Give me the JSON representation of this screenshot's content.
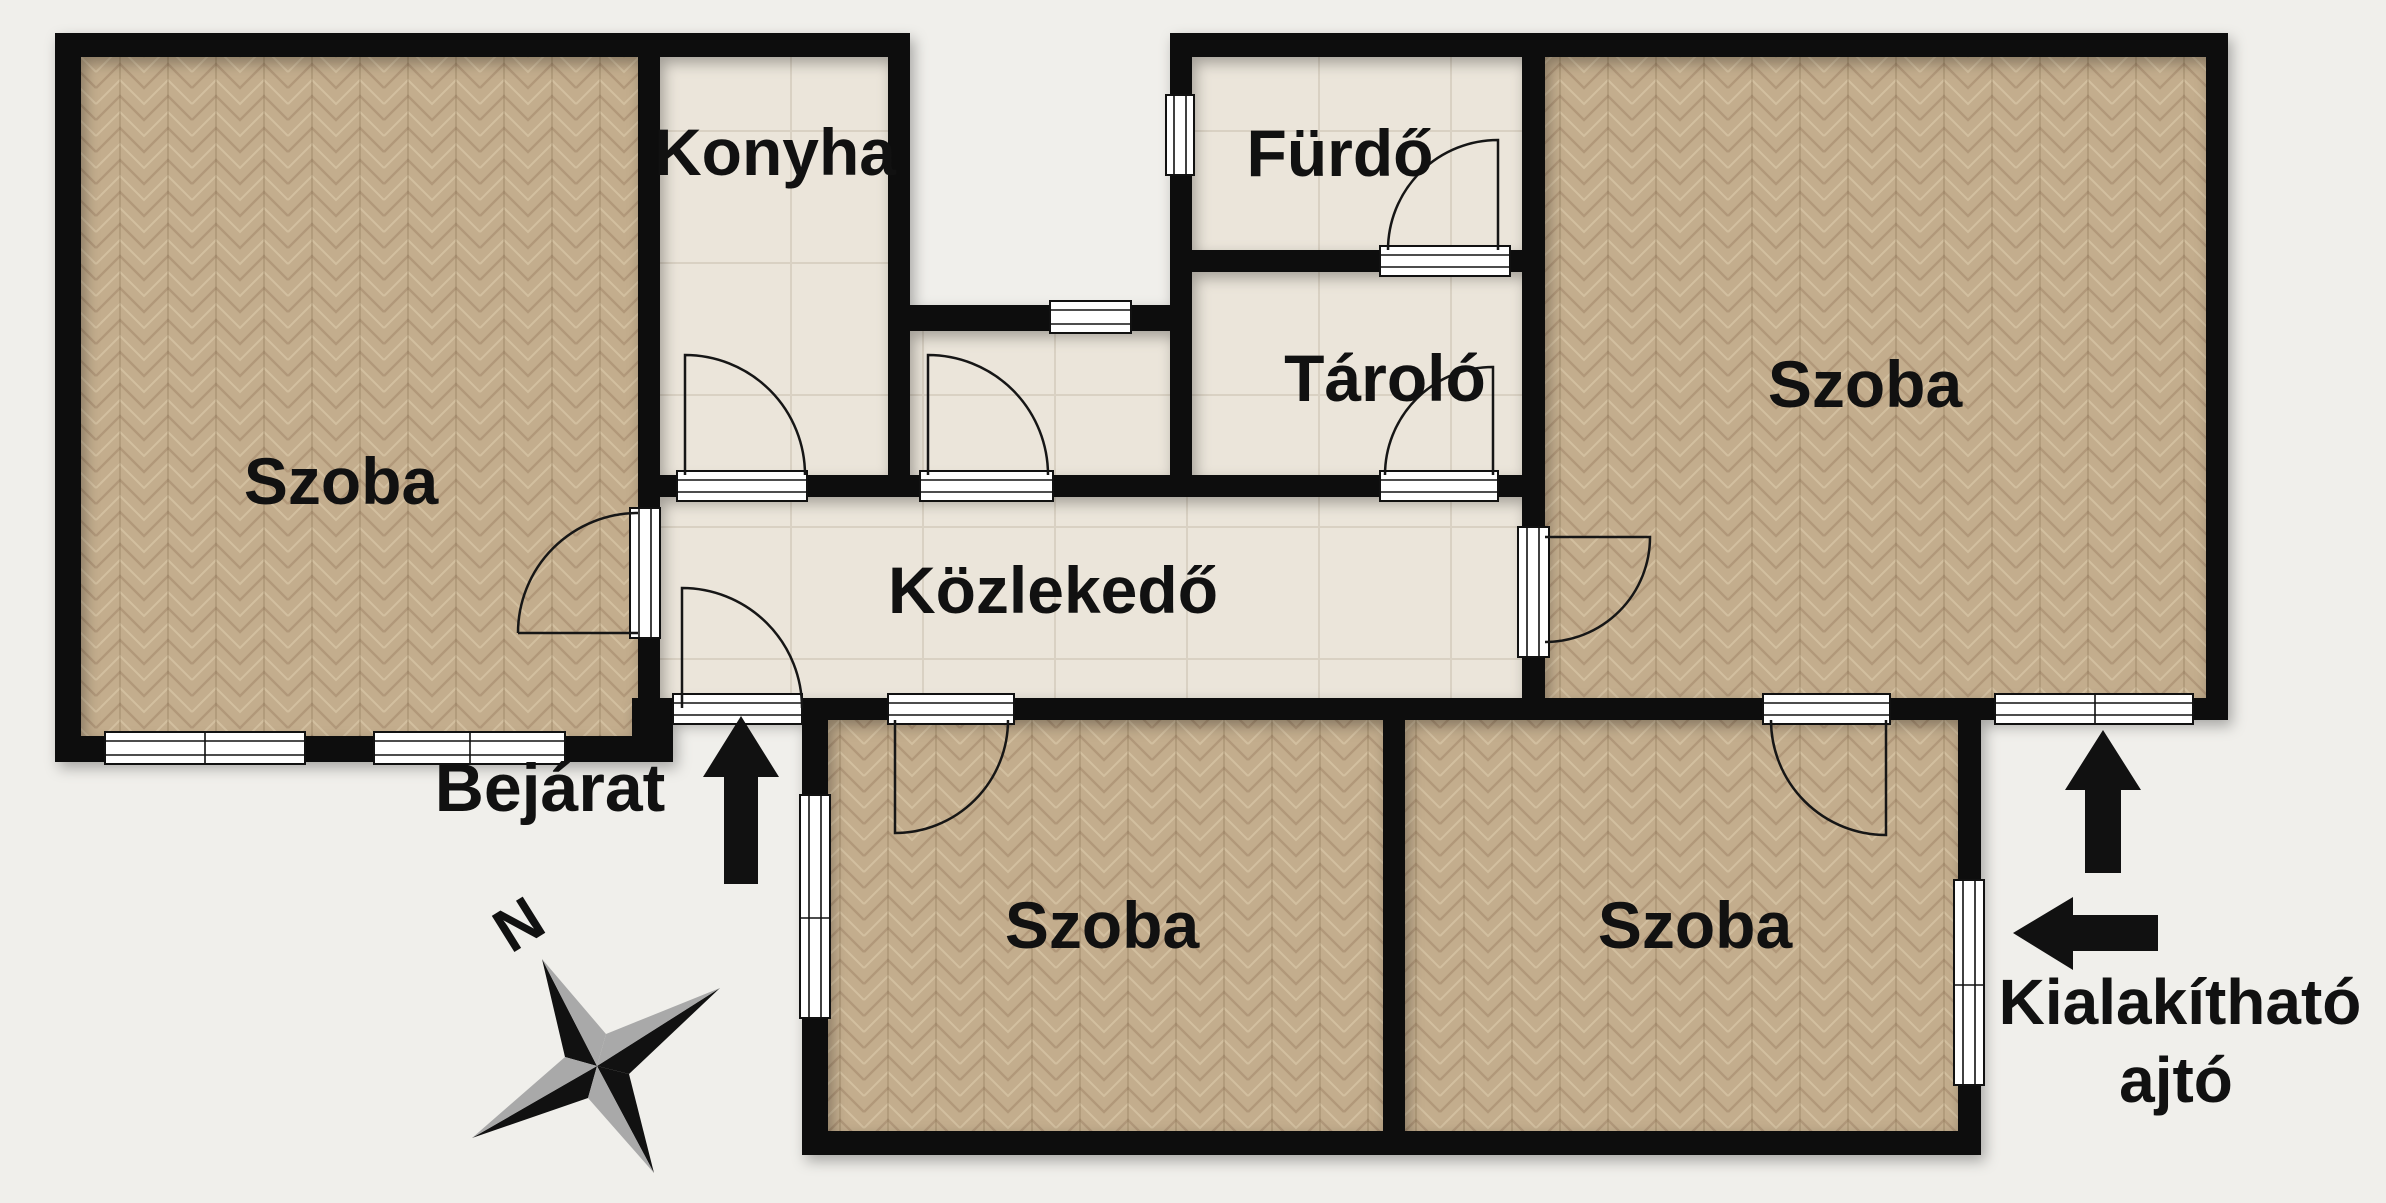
{
  "floorplan": {
    "rooms": [
      {
        "id": "szoba-top-left",
        "label": "Szoba",
        "floor": "parquet"
      },
      {
        "id": "konyha",
        "label": "Konyha",
        "floor": "tile"
      },
      {
        "id": "furdo",
        "label": "Fürdő",
        "floor": "tile"
      },
      {
        "id": "tarolo",
        "label": "Tároló",
        "floor": "tile"
      },
      {
        "id": "kozlekedo",
        "label": "Közlekedő",
        "floor": "tile"
      },
      {
        "id": "szoba-top-right",
        "label": "Szoba",
        "floor": "parquet"
      },
      {
        "id": "szoba-bottom-left",
        "label": "Szoba",
        "floor": "parquet"
      },
      {
        "id": "szoba-bottom-right",
        "label": "Szoba",
        "floor": "parquet"
      }
    ],
    "annotations": {
      "entrance_label": "Bejárat",
      "convertible_door_line1": "Kialakítható",
      "convertible_door_line2": "ajtó",
      "compass_north_label": "N"
    },
    "colors": {
      "background": "#f0efeb",
      "wall": "#0d0d0d",
      "parquet_base": "#c3ad8d",
      "parquet_seam_dark": "#ab9274",
      "parquet_seam_light": "#d6c3a4",
      "tile_base": "#ebe5da",
      "tile_seam": "#d9d1c3",
      "annotation_black": "#111111",
      "compass_gray": "#a9a9a9"
    }
  }
}
